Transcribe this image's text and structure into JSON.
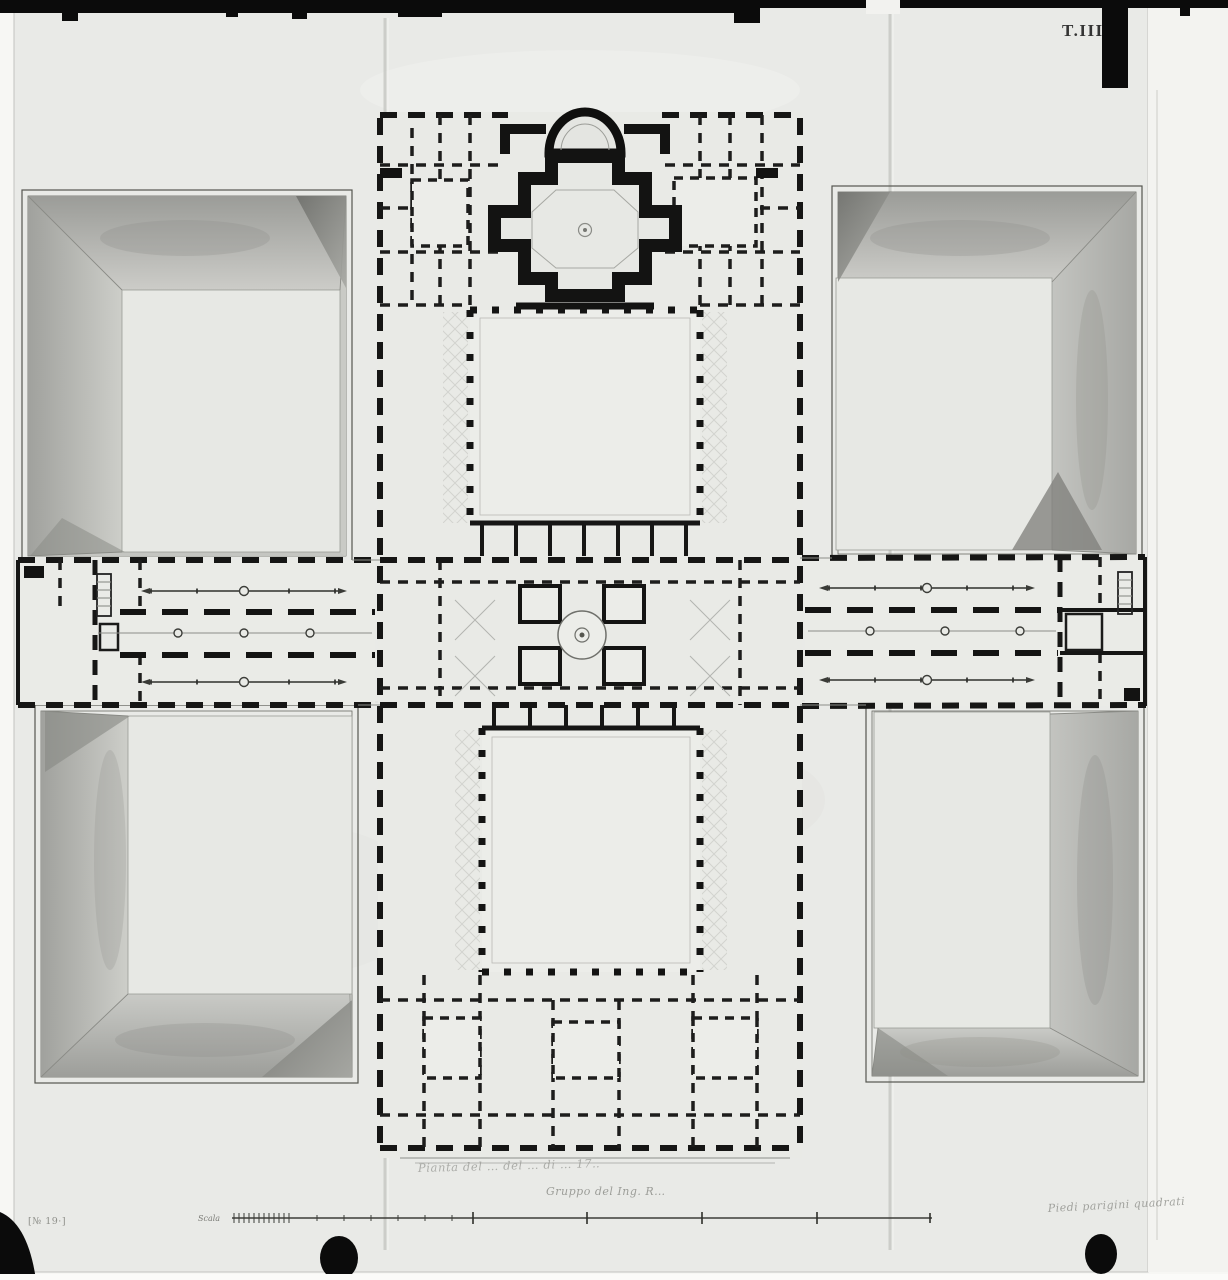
{
  "photo": {
    "description": "Black-and-white archival photograph of an ink-and-wash architectural floor plan: a long symmetrical palace block with chapel, two inner cloister courts and a central rotunda, flanked by lateral wings and four large bevelled sunken courtyards; paper shows fold creases and film-border marks",
    "plate_label": "T.III.",
    "archive_mark": "[№ 19·]",
    "inscriptions": {
      "note_line1": "Pianta del … del … di … 17‥",
      "note_line2": "Gruppo del Ing. R…",
      "note_bottom_right": "Piedi parigini quadrati",
      "scale_label": "Scala"
    },
    "colors": {
      "paper": "#e9eae7",
      "ink": "#161615",
      "wash_dark": "#8d8e8a",
      "wash_light": "#cfd0cc",
      "film_black": "#0b0b0b"
    }
  }
}
